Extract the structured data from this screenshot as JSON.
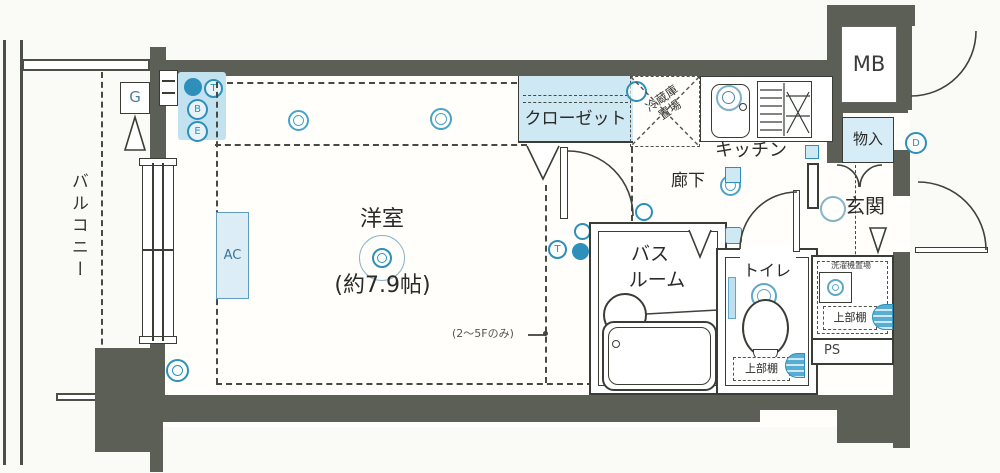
{
  "plan": {
    "balcony_label": "バルコニー",
    "room_label": "洋室",
    "room_size": "(約7.9帖)",
    "floor_note": "(2〜5Fのみ)",
    "closet_label": "クローゼット",
    "fridge_label_1": "冷蔵庫",
    "fridge_label_2": "置場",
    "kitchen_label": "キッチン",
    "hall_label": "廊下",
    "bath_label_1": "バス",
    "bath_label_2": "ルーム",
    "toilet_label": "トイレ",
    "entrance_label": "玄関",
    "mb_label": "MB",
    "storage_label": "物入",
    "washer_label": "洗濯機置場",
    "toilet_shelf_label": "上部棚",
    "washer_shelf_label": "上部棚",
    "ps_label": "PS",
    "ac_label": "AC",
    "gas_label": "G",
    "symbol_letters": {
      "t": "T",
      "b": "B",
      "e": "E",
      "d": "D"
    }
  },
  "colors": {
    "wall": "#5b5f55",
    "accent_blue": "#2d8fba",
    "light_blue_fill": "#cfe9f4",
    "line": "#3a3d36"
  }
}
